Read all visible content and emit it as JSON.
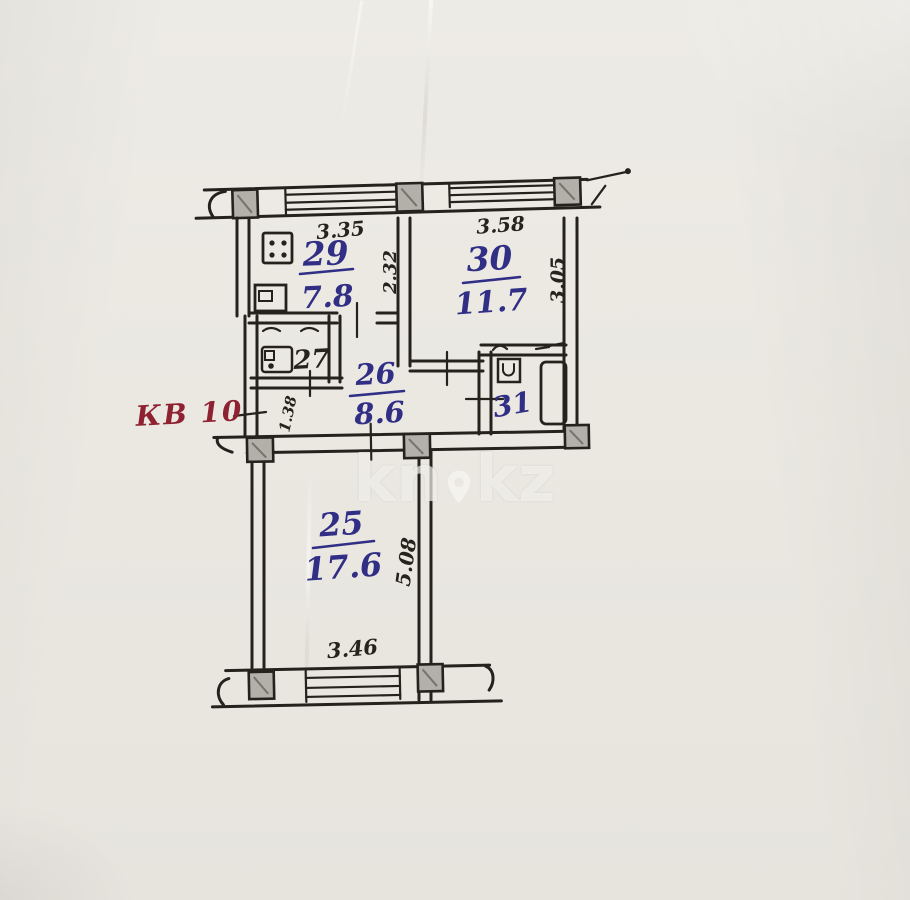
{
  "page": {
    "background": "#eae8e1"
  },
  "plan": {
    "apartment_label": "КВ 10",
    "rooms": [
      {
        "id": "kitchen",
        "number": "29",
        "area": "7.8"
      },
      {
        "id": "room-30",
        "number": "30",
        "area": "11.7"
      },
      {
        "id": "wc",
        "number": "27",
        "area": ""
      },
      {
        "id": "hall",
        "number": "26",
        "area": "8.6"
      },
      {
        "id": "bathroom",
        "number": "31",
        "area": ""
      },
      {
        "id": "room-25",
        "number": "25",
        "area": "17.6"
      }
    ],
    "dimensions": {
      "kitchen_width": "3.35",
      "room30_width": "3.58",
      "kitchen_depth": "2.32",
      "room30_depth": "3.05",
      "entry_width": "1.38",
      "room25_depth": "5.08",
      "room25_width": "3.46"
    },
    "ink": {
      "blue": "#312e85",
      "black": "#26231d",
      "red": "#8e2231",
      "column_gray": "#b3b0a9"
    }
  },
  "watermark": {
    "left": "kn",
    "right": "kz"
  }
}
